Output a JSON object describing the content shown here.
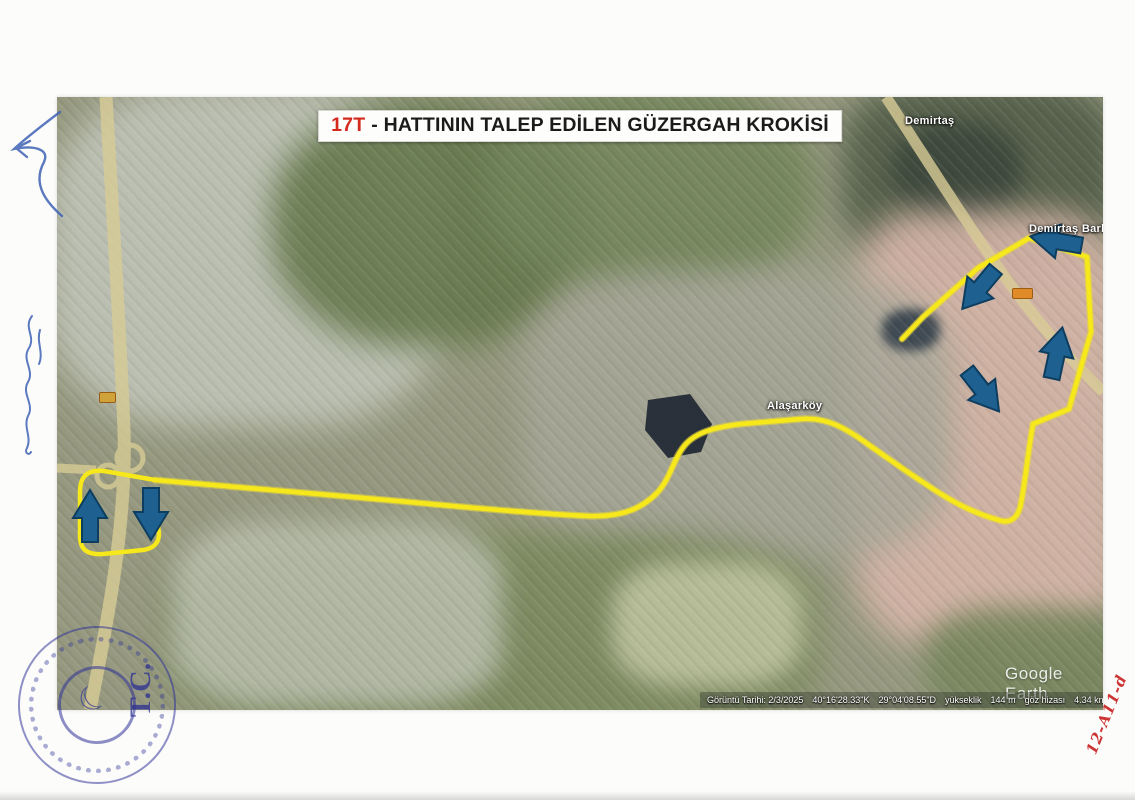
{
  "title": {
    "line": "17T",
    "rest": "- HATTININ TALEP EDİLEN GÜZERGAH KROKİSİ"
  },
  "map": {
    "labels": {
      "demirtas": "Demirtaş",
      "demirtas_barb": "Demirtaş Barb",
      "alasarkoy": "Alaşarköy"
    },
    "watermark": "Google Earth",
    "status": {
      "date": "Görüntü Tarihi: 2/3/2025",
      "lat": "40°16'28.33\"K",
      "lon": "29°04'08.55\"D",
      "elev_label": "yükseklik",
      "elev": "144 m",
      "eye_label": "göz hizası",
      "eye": "4.34 km"
    }
  },
  "stamp": {
    "text": "T.C."
  },
  "annotations": {
    "sheet_code": "12-A11-d"
  },
  "colors": {
    "route_yellow": "#f2e11c",
    "arrow_blue": "#1e6090",
    "stamp_blue": "#2b2f96",
    "title_red": "#d42a1e",
    "code_red": "#cc3434"
  }
}
